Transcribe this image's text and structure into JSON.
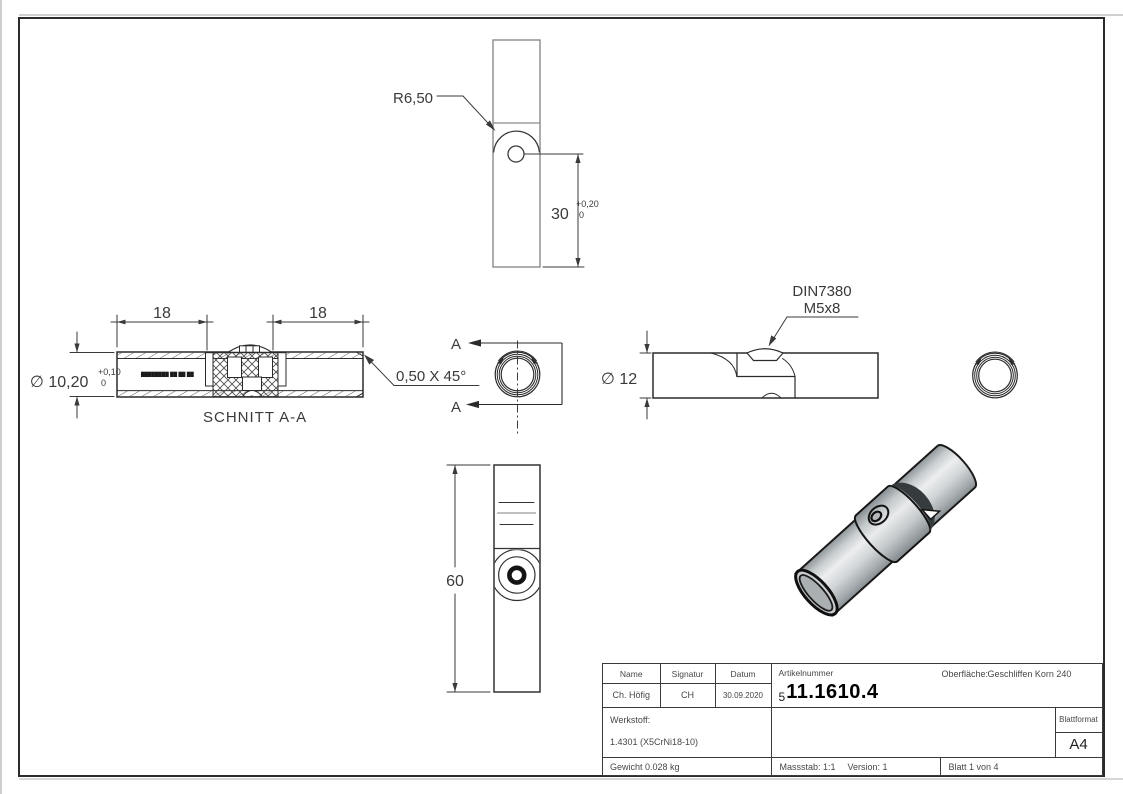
{
  "sheet": {
    "colors": {
      "line": "#2b2b2b",
      "light_line": "#8a8a8a",
      "metal_light": "#eceeef",
      "metal_dark": "#878e92",
      "background": "#ffffff"
    }
  },
  "views": {
    "top": {
      "radius_label": "R6,50",
      "dim": "30",
      "tol_plus": "+0,20",
      "tol_zero": "0"
    },
    "section": {
      "title": "SCHNITT A-A",
      "dim_left": "18",
      "dim_right": "18",
      "dia_label": "∅ 10,20",
      "tol_plus": "+0,10",
      "tol_zero": "0",
      "chamfer_label": "0,50 X 45°",
      "section_letter": "A",
      "marking": "████████ ██ ██ ██"
    },
    "side": {
      "dia_label": "∅ 12",
      "screw_note_line1": "DIN7380",
      "screw_note_line2": "M5x8"
    },
    "front": {
      "dim": "60"
    }
  },
  "title_block": {
    "headers": {
      "name": "Name",
      "signatur": "Signatur",
      "datum": "Datum",
      "artikelnummer": "Artikelnummer",
      "oberflaeche_label": "Oberfläche:",
      "oberflaeche_value": "Geschliffen Korn 240",
      "blattformat": "Blattformat"
    },
    "values": {
      "name": "Ch. Höfig",
      "signatur": "CH",
      "datum": "30.09.2020",
      "artikel_prefix": "5",
      "artikel_number": "11.1610.4",
      "werkstoff_label": "Werkstoff:",
      "werkstoff_value": "1.4301 (X5CrNi18-10)",
      "format": "A4",
      "gewicht": "Gewicht 0.028 kg",
      "massstab": "Massstab: 1:1",
      "version": "Version: 1",
      "blatt": "Blatt 1 von 4"
    }
  }
}
